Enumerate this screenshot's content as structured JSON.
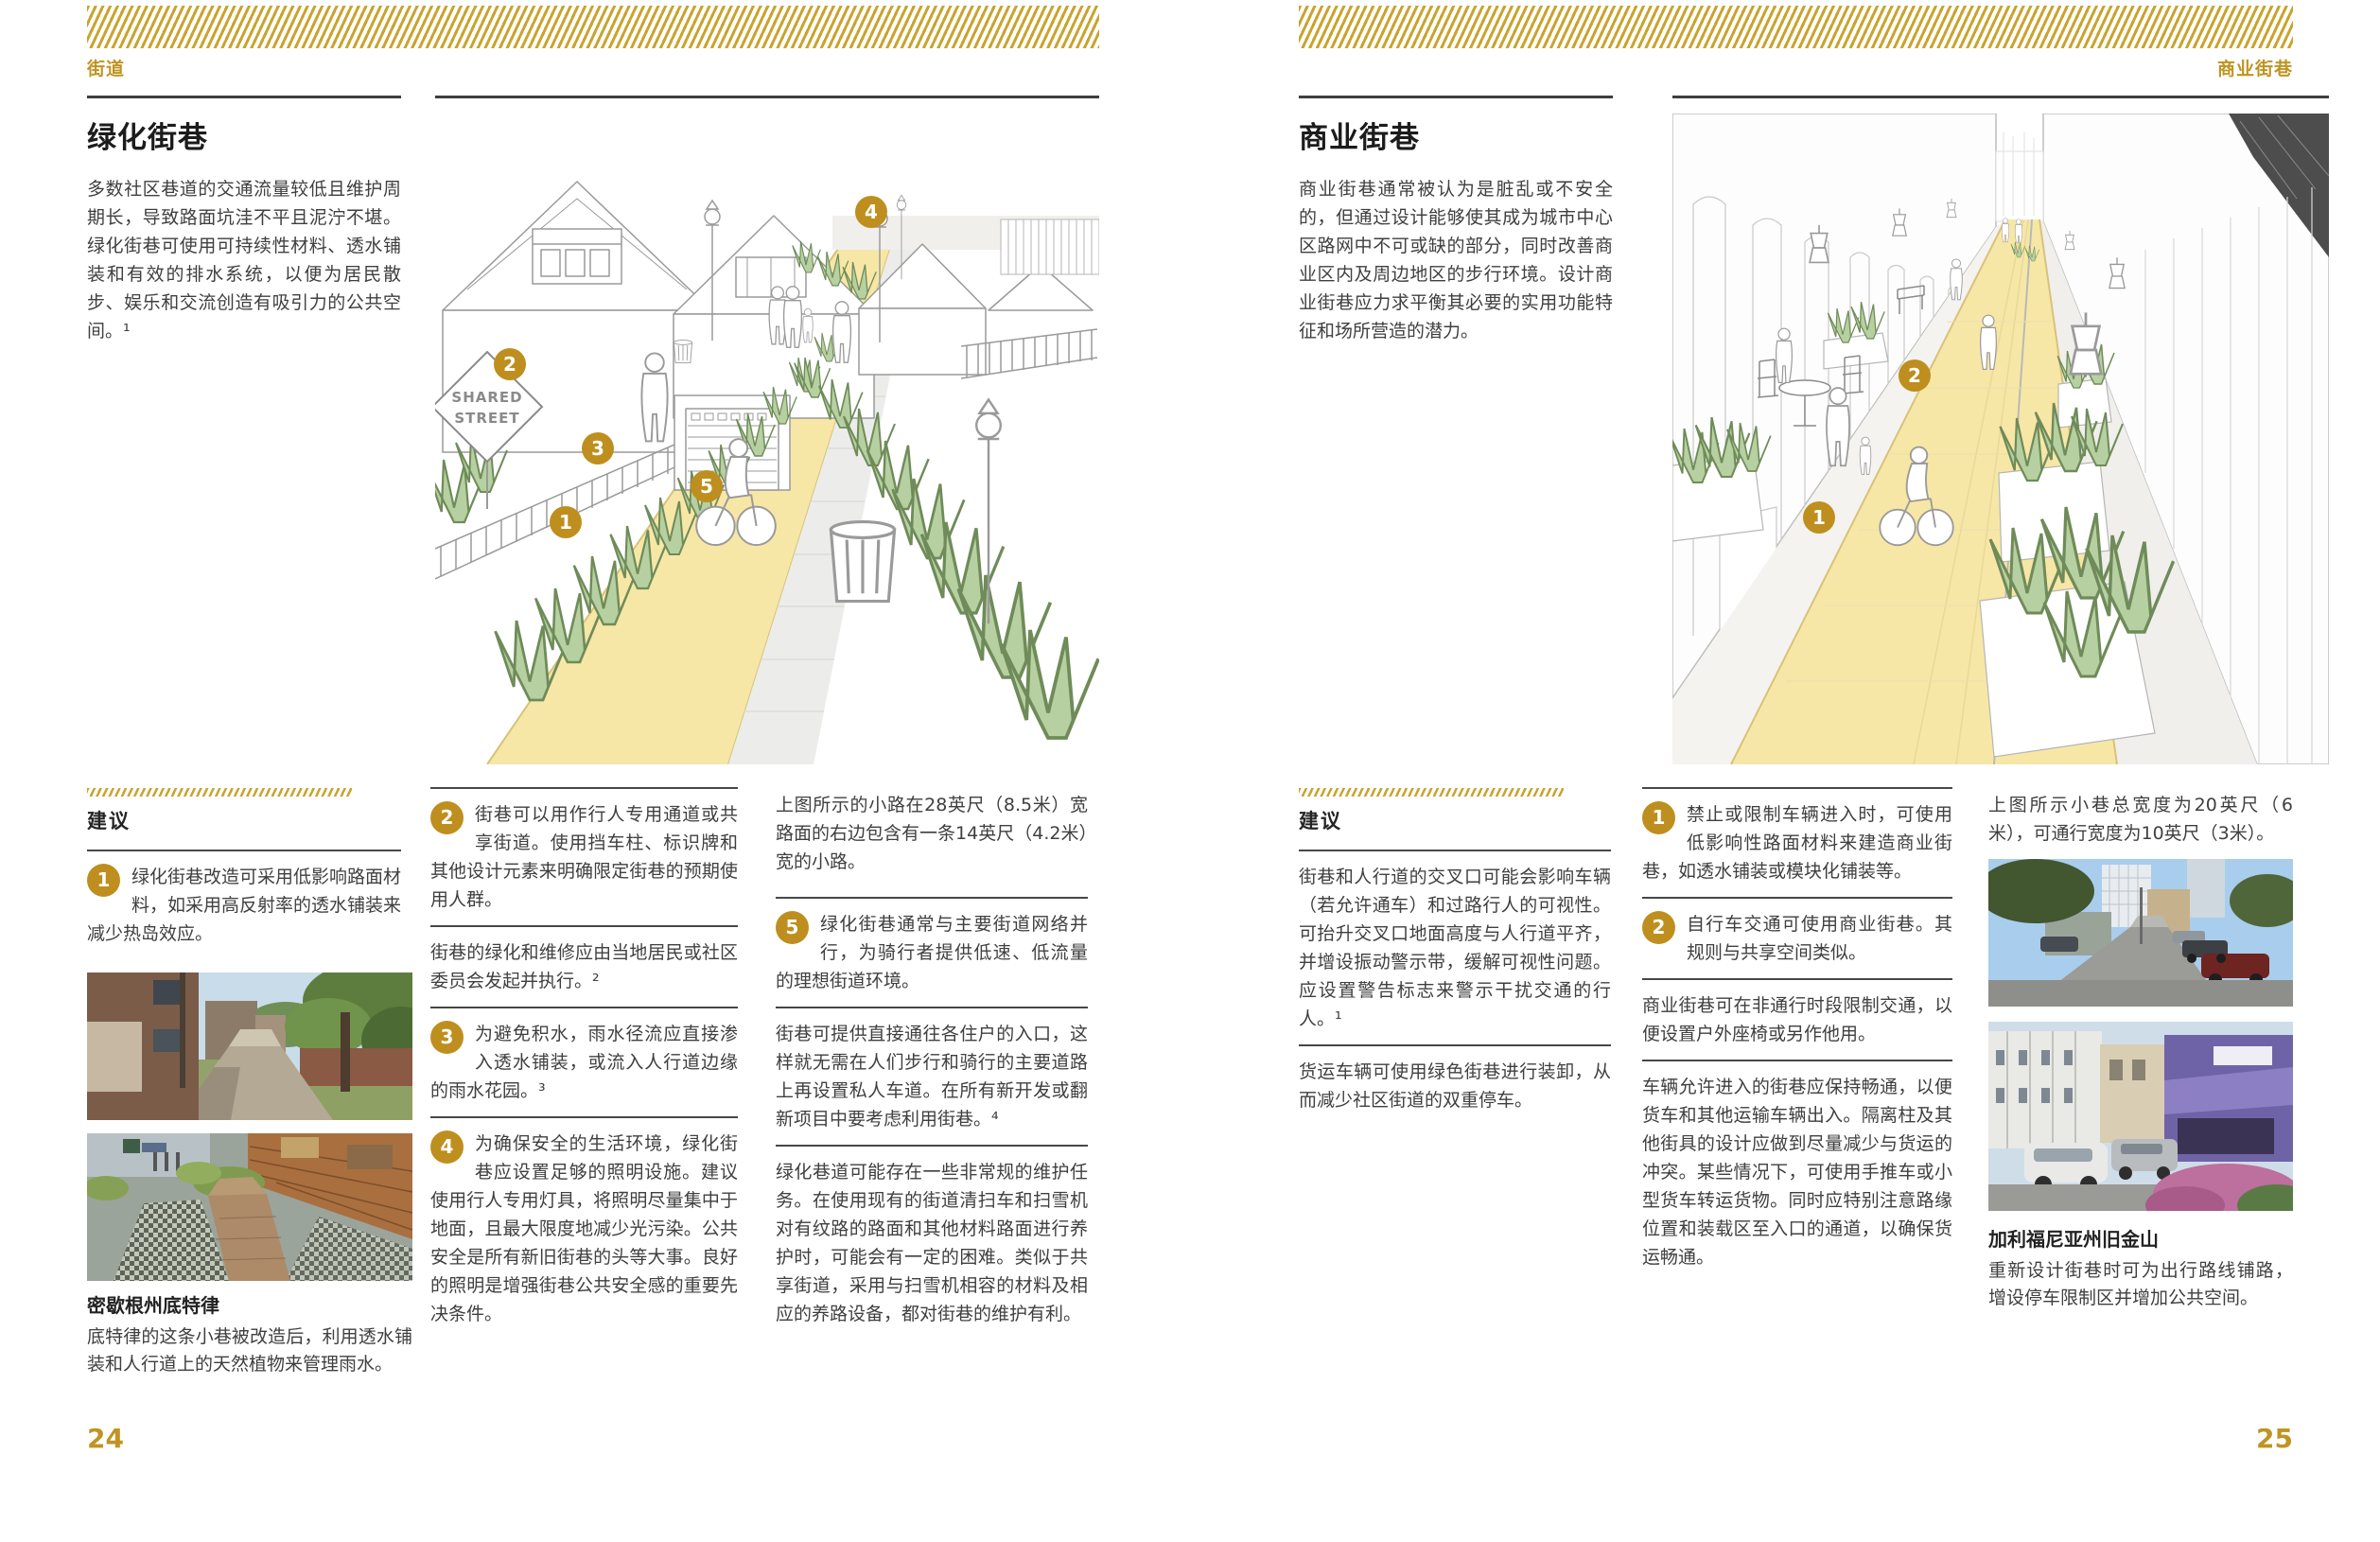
{
  "colors": {
    "gold": "#be8f1e",
    "gold_band": "#c9a42f",
    "body_text": "#3f3f3f",
    "rule": "#474747",
    "path_yellow": "#f7e7a6",
    "plant_green": "#b7d0a1"
  },
  "left_page": {
    "eyebrow": "街道",
    "page_number": "24",
    "title": "绿化街巷",
    "intro": "多数社区巷道的交通流量较低且维护周期长，导致路面坑洼不平且泥泞不堪。绿化街巷可使用可持续性材料、透水铺装和有效的排水系统，以便为居民散步、娱乐和交流创造有吸引力的公共空间。¹",
    "recommendations_label": "建议",
    "items": {
      "r1": {
        "num": "1",
        "text": "绿化街巷改造可采用低影响路面材料，如采用高反射率的透水铺装来减少热岛效应。"
      },
      "r2": {
        "num": "2",
        "text": "街巷可以用作行人专用通道或共享街道。使用挡车柱、标识牌和其他设计元素来明确限定街巷的预期使用人群。"
      },
      "p1": {
        "text": "街巷的绿化和维修应由当地居民或社区委员会发起并执行。²"
      },
      "r3": {
        "num": "3",
        "text": "为避免积水，雨水径流应直接渗入透水铺装，或流入人行道边缘的雨水花园。³"
      },
      "r4": {
        "num": "4",
        "text": "为确保安全的生活环境，绿化街巷应设置足够的照明设施。建议使用行人专用灯具，将照明尽量集中于地面，且最大限度地减少光污染。公共安全是所有新旧街巷的头等大事。良好的照明是增强街巷公共安全感的重要先决条件。"
      },
      "caption": {
        "text": "上图所示的小路在28英尺（8.5米）宽路面的右边包含有一条14英尺（4.2米）宽的小路。"
      },
      "r5": {
        "num": "5",
        "text": "绿化街巷通常与主要街道网络并行，为骑行者提供低速、低流量的理想街道环境。"
      },
      "p2": {
        "text": "街巷可提供直接通往各住户的入口，这样就无需在人们步行和骑行的主要道路上再设置私人车道。在所有新开发或翻新项目中要考虑利用街巷。⁴"
      },
      "p3": {
        "text": "绿化巷道可能存在一些非常规的维护任务。在使用现有的街道清扫车和扫雪机对有纹路的路面和其他材料路面进行养护时，可能会有一定的困难。类似于共享街道，采用与扫雪机相容的材料及相应的养路设备，都对街巷的维护有利。"
      }
    },
    "photo_caption": {
      "title": "密歇根州底特律",
      "text": "底特律的这条小巷被改造后，利用透水铺装和人行道上的天然植物来管理雨水。"
    },
    "illustration": {
      "sign_top": "SHARED",
      "sign_bottom": "STREET",
      "markers": {
        "m1": "1",
        "m2": "2",
        "m3": "3",
        "m4": "4",
        "m5": "5"
      }
    }
  },
  "right_page": {
    "eyebrow": "商业街巷",
    "page_number": "25",
    "title": "商业街巷",
    "intro": "商业街巷通常被认为是脏乱或不安全的，但通过设计能够使其成为城市中心区路网中不可或缺的部分，同时改善商业区内及周边地区的步行环境。设计商业街巷应力求平衡其必要的实用功能特征和场所营造的潜力。",
    "recommendations_label": "建议",
    "items": {
      "p1": {
        "text": "街巷和人行道的交叉口可能会影响车辆（若允许通车）和过路行人的可视性。可抬升交叉口地面高度与人行道平齐，并增设振动警示带，缓解可视性问题。应设置警告标志来警示干扰交通的行人。¹"
      },
      "p2": {
        "text": "货运车辆可使用绿色街巷进行装卸，从而减少社区街道的双重停车。"
      },
      "r1": {
        "num": "1",
        "text": "禁止或限制车辆进入时，可使用低影响性路面材料来建造商业街巷，如透水铺装或模块化铺装等。"
      },
      "r2": {
        "num": "2",
        "text": "自行车交通可使用商业街巷。其规则与共享空间类似。"
      },
      "p3": {
        "text": "商业街巷可在非通行时段限制交通，以便设置户外座椅或另作他用。"
      },
      "p4": {
        "text": "车辆允许进入的街巷应保持畅通，以便货车和其他运输车辆出入。隔离柱及其他街具的设计应做到尽量减少与货运的冲突。某些情况下，可使用手推车或小型货车转运货物。同时应特别注意路缘位置和装载区至入口的通道，以确保货运畅通。"
      },
      "caption": {
        "text": "上图所示小巷总宽度为20英尺（6米），可通行宽度为10英尺（3米）。"
      }
    },
    "photo_caption": {
      "title": "加利福尼亚州旧金山",
      "text": "重新设计街巷时可为出行路线铺路，增设停车限制区并增加公共空间。"
    },
    "illustration": {
      "markers": {
        "m1": "1",
        "m2": "2"
      }
    }
  }
}
